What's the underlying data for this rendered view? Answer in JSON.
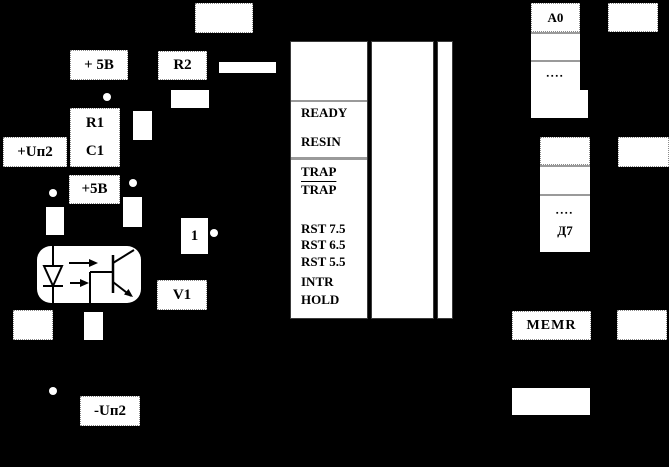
{
  "boxes": {
    "plus5v_top": "+ 5В",
    "r2": "R2",
    "r1": "R1",
    "c1": "C1",
    "plus_up2": "+Uп2",
    "plus5v": "+5В",
    "gate_one": "1",
    "v1": "V1",
    "minus_up2": "-Uп2",
    "memr": "MEMR"
  },
  "cpu_pins": {
    "ready": "READY",
    "resin": "RESIN",
    "trap": "TRAP",
    "trap_inv": "TRAP",
    "rst75": "RST 7.5",
    "rst65": "RST 6.5",
    "rst55": "RST 5.5",
    "intr": "INTR",
    "hold": "HOLD"
  },
  "address_bus": [
    "A0",
    "",
    "▪▪▪▪",
    ""
  ],
  "data_bus": [
    "",
    "",
    "▪▪▪▪",
    "Д7"
  ],
  "colors": {
    "background": "#000000",
    "box_fill": "#ffffff",
    "ink": "#000000",
    "separator": "#9a9a9a"
  }
}
